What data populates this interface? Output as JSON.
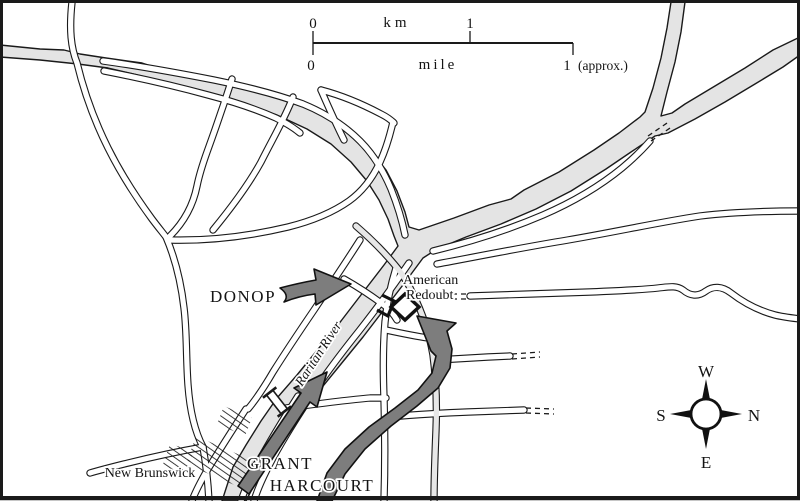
{
  "map": {
    "title_context": "battle map",
    "labels": {
      "donop": "DONOP",
      "grant": "GRANT",
      "harcourt": "HARCOURT",
      "american_redoubt_line1": "American",
      "american_redoubt_line2": "Redoubt",
      "new_brunswick": "New Brunswick",
      "raritan_river": "Raritan River"
    },
    "scale_bar": {
      "km_zero": "0",
      "km_label": "km",
      "km_one": "1",
      "mile_zero": "0",
      "mile_label": "mile",
      "mile_one": "1",
      "approx": "(approx.)"
    },
    "compass": {
      "top": "W",
      "right": "N",
      "left": "S",
      "bottom": "E"
    },
    "colors": {
      "river": "#e4e4e4",
      "arrow_gray": "#7d7d7d",
      "road": "#ffffff",
      "ink": "#1a1a1a"
    }
  }
}
